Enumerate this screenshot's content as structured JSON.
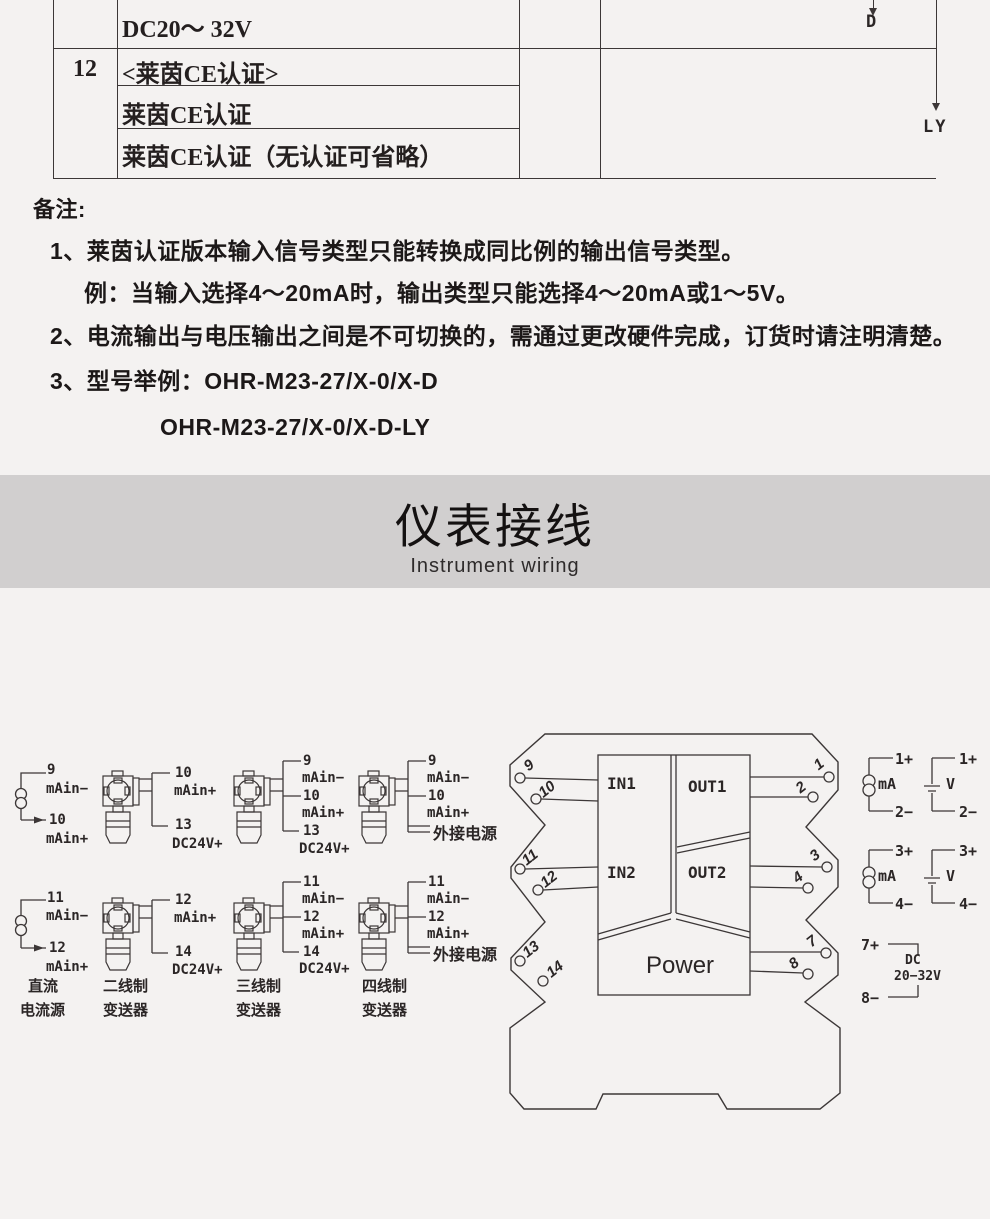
{
  "table": {
    "col_index": "12",
    "row_power": "DC20～ 32V",
    "row_ce_header": "<莱茵CE认证>",
    "row_ce_1": "莱茵CE认证",
    "row_ce_2": "莱茵CE认证（无认证可省略）",
    "code_d": "D",
    "code_ly": "LY"
  },
  "notes": {
    "heading": "备注:",
    "line1": "1、莱茵认证版本输入信号类型只能转换成同比例的输出信号类型。",
    "line1_example": "例：当输入选择4～20mA时，输出类型只能选择4～20mA或1～5V。",
    "line2": "2、电流输出与电压输出之间是不可切换的，需通过更改硬件完成，订货时请注明清楚。",
    "line3": "3、型号举例：OHR-M23-27/X-0/X-D",
    "line3_model2": "OHR-M23-27/X-0/X-D-LY"
  },
  "section": {
    "title": "仪表接线",
    "subtitle": "Instrument wiring"
  },
  "wiring": {
    "dc_source": {
      "top": {
        "t1": "9",
        "s1": "mAin−",
        "t2": "10",
        "s2": "mAin+"
      },
      "bottom": {
        "t1": "11",
        "s1": "mAin−",
        "t2": "12",
        "s2": "mAin+"
      },
      "name1": "直流",
      "name2": "电流源"
    },
    "two_wire": {
      "top": {
        "t1": "10",
        "s1": "mAin+",
        "t2": "13",
        "s2": "DC24V+"
      },
      "bottom": {
        "t1": "12",
        "s1": "mAin+",
        "t2": "14",
        "s2": "DC24V+"
      },
      "name1": "二线制",
      "name2": "变送器"
    },
    "three_wire": {
      "top": {
        "t1": "9",
        "s1": "mAin−",
        "t2": "10",
        "s2": "mAin+",
        "t3": "13",
        "s3": "DC24V+"
      },
      "bottom": {
        "t1": "11",
        "s1": "mAin−",
        "t2": "12",
        "s2": "mAin+",
        "t3": "14",
        "s3": "DC24V+"
      },
      "name1": "三线制",
      "name2": "变送器"
    },
    "four_wire": {
      "top": {
        "t1": "9",
        "s1": "mAin−",
        "t2": "10",
        "s2": "mAin+",
        "power": "外接电源"
      },
      "bottom": {
        "t1": "11",
        "s1": "mAin−",
        "t2": "12",
        "s2": "mAin+",
        "power": "外接电源"
      },
      "name1": "四线制",
      "name2": "变送器"
    },
    "module": {
      "in1": "IN1",
      "out1": "OUT1",
      "in2": "IN2",
      "out2": "OUT2",
      "power": "Power",
      "left_terms": [
        "9",
        "10",
        "11",
        "12",
        "13",
        "14"
      ],
      "right_terms": [
        "1",
        "2",
        "3",
        "4",
        "7",
        "8"
      ]
    },
    "meters": {
      "ma": "mA",
      "v": "V",
      "p1": "1+",
      "m2": "2−",
      "p3": "3+",
      "m4": "4−",
      "p7": "7+",
      "m8": "8−",
      "dc_line1": "DC",
      "dc_line2": "20−32V"
    }
  },
  "colors": {
    "line": "#3c3737",
    "band": "#d1cfcf",
    "page_bg": "#f4f2f1"
  }
}
